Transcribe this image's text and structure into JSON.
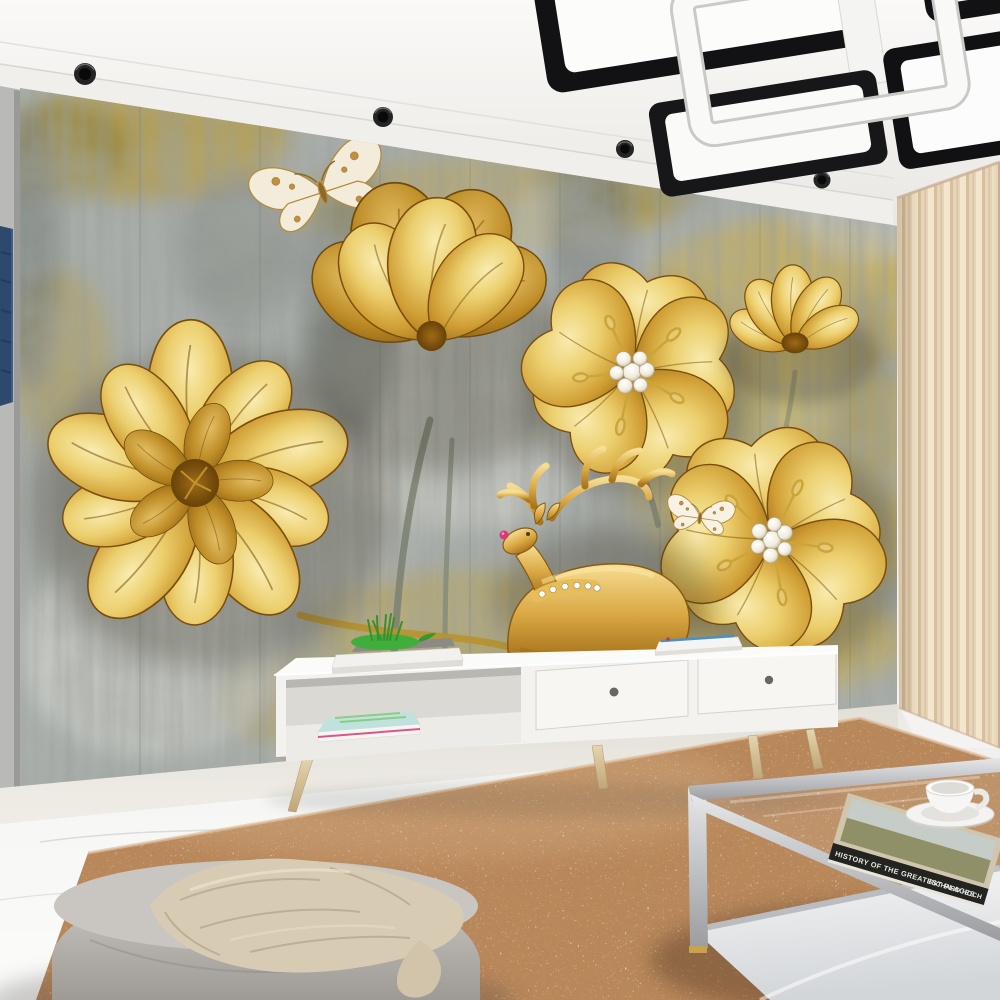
{
  "scene": {
    "title": "Living room with golden 3D flower mural wallpaper",
    "type": "interior photo render"
  },
  "ceiling": {
    "fixture": "black and white geometric LED ceiling lamp",
    "spotlight_count": 4,
    "color": "#f4f3f1"
  },
  "wall_mural": {
    "description": "grunge painted wall in grey, cream and mustard with 3D golden flowers, two butterflies and a jewelled golden deer",
    "elements": [
      "large gold lily",
      "gold tulip bloom",
      "jewelled five petal flower center",
      "small gold lotus",
      "jewelled five petal flower right",
      "gold deer with ruby nose and diamond collar",
      "large butterfly",
      "small butterfly"
    ],
    "colors": {
      "base": "#a9afac",
      "gold": "#cf9d33",
      "mustard": "#d3b13c",
      "dark": "#5f6765",
      "light": "#e8e7e0"
    }
  },
  "window_treatments": {
    "right_curtain_color": "#ecd9bf",
    "left_curtain_color": "#2d4a6d"
  },
  "furniture": {
    "tv_stand": {
      "color": "#f3f2ef",
      "leg_color": "#d8c49c",
      "drawers": 2,
      "top_items": [
        "white book stack",
        "green leaf tray with grass plant",
        "magazine stack"
      ],
      "shelf_items": [
        "magazine stack with teal cover"
      ]
    },
    "coffee_table": {
      "frame_color": "#b9bcc0",
      "book": {
        "title": "HISTORY OF THE GREATEST PLACES",
        "author": "RICHARD HOCH"
      },
      "tableware": "white cup and saucer"
    },
    "pouf": {
      "color": "#c6c3bf",
      "blanket_color": "#d8cbb3"
    }
  },
  "floor": {
    "material": "white marble",
    "rug_color": "#b8875a"
  }
}
